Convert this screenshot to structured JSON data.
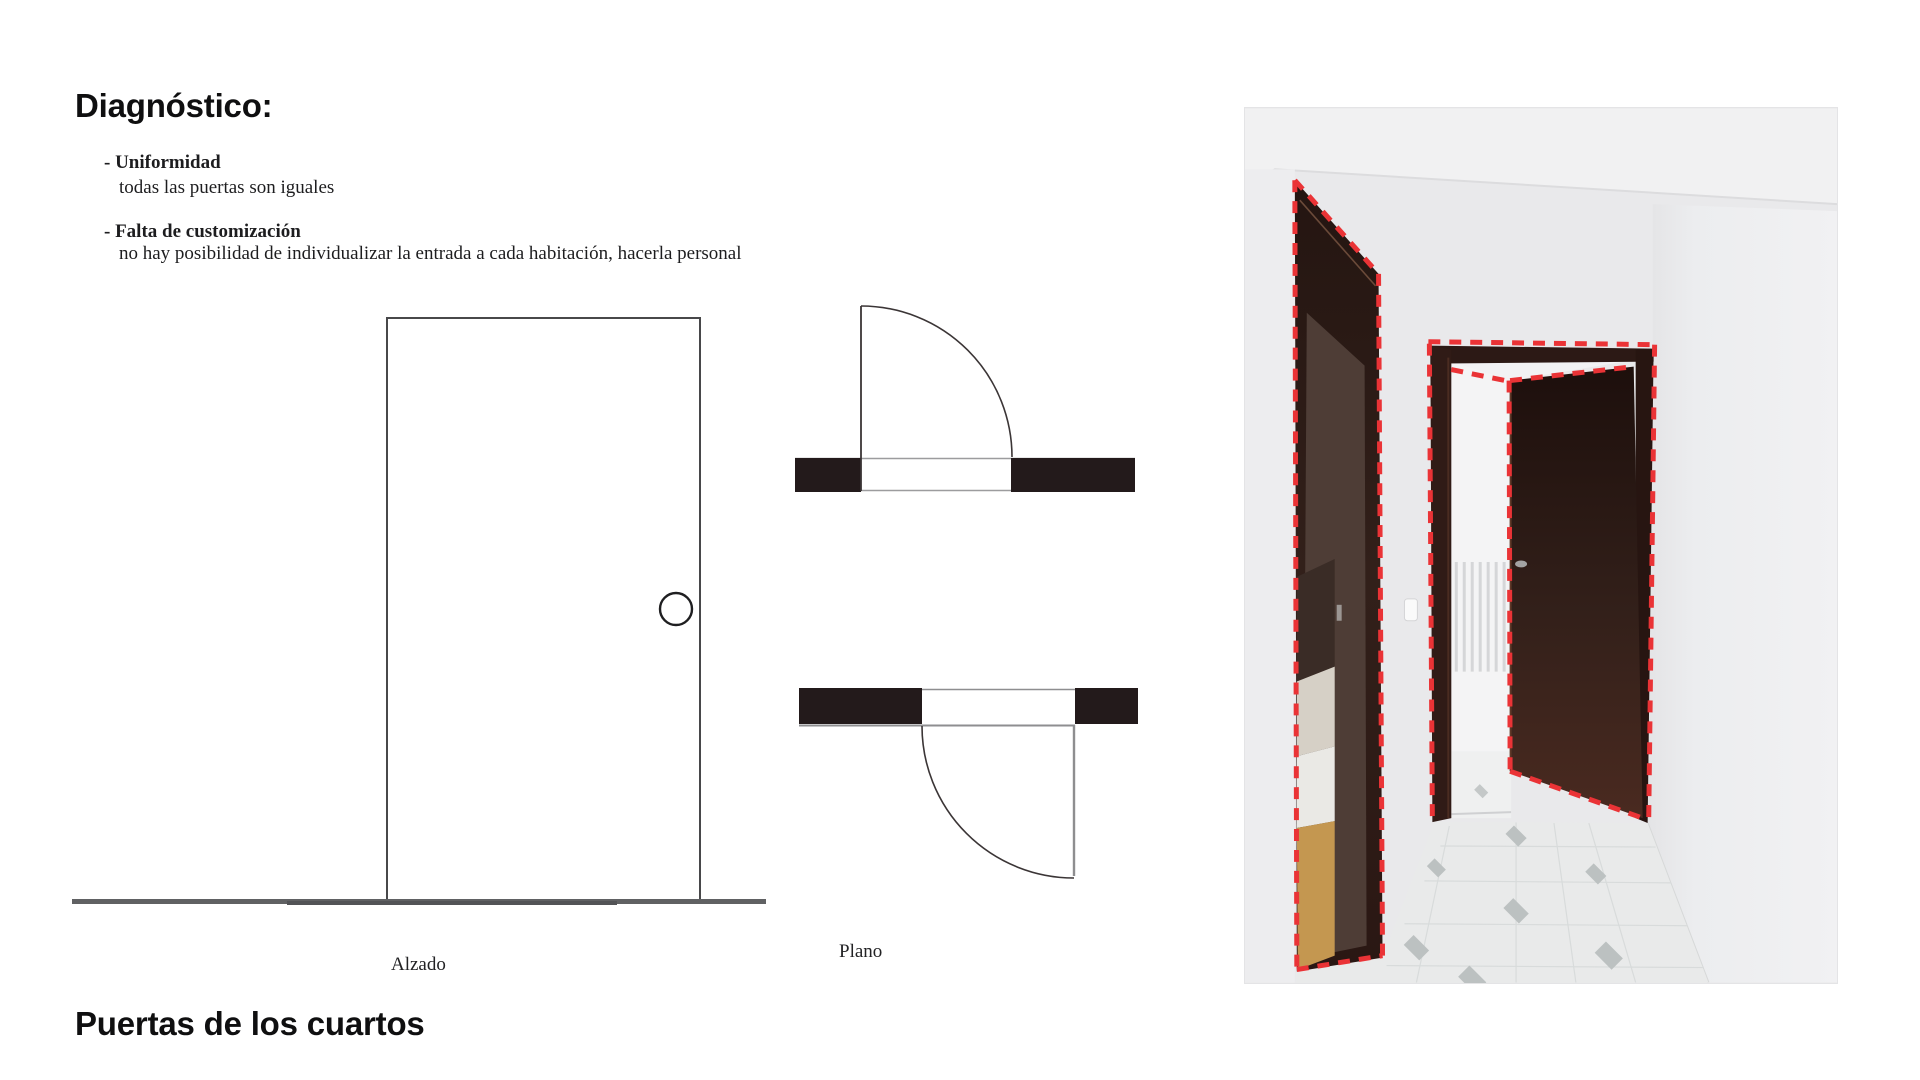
{
  "slide": {
    "title": "Diagnóstico:",
    "bullets": [
      {
        "term": "- Uniformidad",
        "desc": "todas las puertas son iguales"
      },
      {
        "term": "- Falta de customización",
        "desc": "no hay posibilidad de individualizar la entrada a cada habitación, hacerla personal"
      }
    ],
    "labels": {
      "elevation": "Alzado",
      "plan": "Plano"
    },
    "footer_title": "Puertas de los cuartos",
    "colors": {
      "ink": "#0f0f10",
      "plan_wall_black": "#231a1b",
      "thin_line_gray": "#8e8e90",
      "ground_line_gray": "#606163",
      "highlight_red": "#ea3336",
      "door_wood_dark": "#261713",
      "door_wood_light": "#4a2a20",
      "wall_white": "#e9e9eb"
    }
  }
}
